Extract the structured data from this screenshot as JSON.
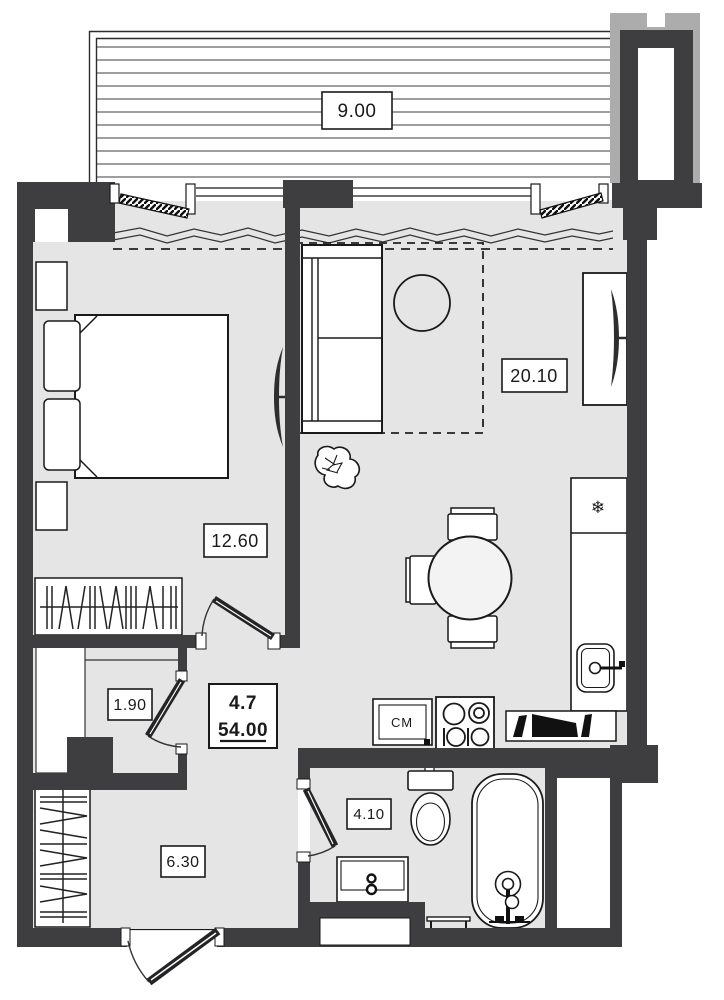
{
  "plan": {
    "apartment_number": "4.7",
    "total_area": "54.00",
    "rooms": {
      "balcony": {
        "name": "balcony",
        "area": "9.00"
      },
      "living": {
        "name": "living-room",
        "area": "20.10"
      },
      "bedroom": {
        "name": "bedroom",
        "area": "12.60"
      },
      "closet": {
        "name": "closet",
        "area": "1.90"
      },
      "hall": {
        "name": "entry-hall",
        "area": "6.30"
      },
      "bathroom": {
        "name": "bathroom",
        "area": "4.10"
      }
    },
    "appliances": {
      "washing_machine_label": "СМ",
      "fridge_symbol": "❄"
    },
    "colors": {
      "wall": "#3e3e40",
      "floor": "#e5e5e6",
      "column_light": "#acacac",
      "outline": "#1a1a1a",
      "white": "#ffffff"
    }
  }
}
